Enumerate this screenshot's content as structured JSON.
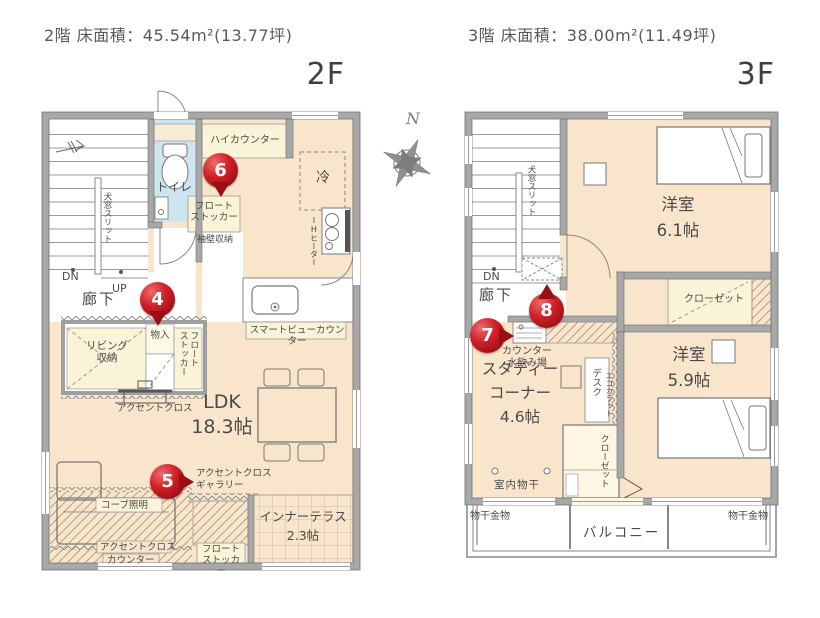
{
  "header": {
    "floor2_title": "2階 床面積：45.54m²(13.77坪)",
    "floor3_title": "3階 床面積：38.00m²(11.49坪)",
    "floor2_label": "2F",
    "floor3_label": "3F",
    "compass_north": "N"
  },
  "palette": {
    "marker_red": "#b5121b",
    "floor_cream": "#f8e5cb",
    "cabinet_yellow": "#faf3d8",
    "toilet_blue": "#cde4f1",
    "wall_gray": "#a8a8a8"
  },
  "floor2": {
    "labels": {
      "toilet": "トイレ",
      "high_counter": "ハイカウンター",
      "fridge": "冷",
      "float_stocker": "フロート\nストッカー",
      "sode_wall_storage": "袖壁収納",
      "ih_heater": "IHヒーター",
      "window_slit": "犬窓スリット",
      "dn": "DN",
      "up": "UP",
      "hallway": "廊下",
      "storage": "物入",
      "living_storage": "リビング\n収納",
      "smart_view_counter": "スマートビューカウンター",
      "accent_cloth": "アクセントクロス",
      "ldk": "LDK\n18.3帖",
      "accent_cloth_gallery": "アクセントクロス\nギャラリー",
      "cove_lighting": "コーブ照明",
      "counter": "カウンター",
      "inner_terrace": "インナーテラス\n2.3帖"
    },
    "markers": {
      "m4": "4",
      "m5": "5",
      "m6": "6"
    }
  },
  "floor3": {
    "labels": {
      "window_slit": "犬窓スリット",
      "dn": "DN",
      "hallway": "廊下",
      "bedroom_61": "洋室\n6.1帖",
      "closet": "クローゼット",
      "counter_water": "カウンター\n水飲み場",
      "study_corner": "スタディー\nコーナー\n4.6帖",
      "desk": "デスク",
      "ecocarat": "エコカラット",
      "bedroom_59": "洋室\n5.9帖",
      "indoor_drying": "室内物干",
      "balcony": "バルコニー",
      "drying_hardware": "物干金物"
    },
    "markers": {
      "m7": "7",
      "m8": "8"
    }
  }
}
